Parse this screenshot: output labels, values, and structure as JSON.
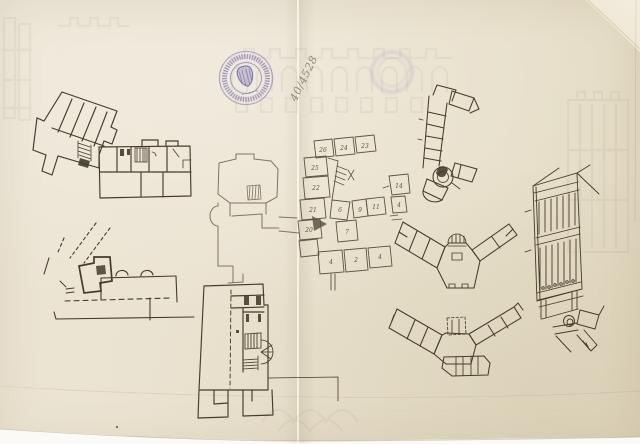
{
  "annotations": {
    "inventory_number": "40/4528",
    "room_numbers": [
      "26",
      "24",
      "23",
      "25",
      "22",
      "21",
      "20",
      "14",
      "11",
      "9",
      "7",
      "6",
      "4",
      "4",
      "4",
      "2"
    ]
  },
  "stamp": {
    "ink_color": "#6053a8",
    "emblem": "harp-shield"
  },
  "palette": {
    "paper": "#eae2cf",
    "backing": "#fbfaf6",
    "ink": "#463b2b",
    "pencil": "#7f7661",
    "pencil_dark": "#5d553f",
    "watermark": "#8d8574",
    "handwriting": "#94897a"
  }
}
